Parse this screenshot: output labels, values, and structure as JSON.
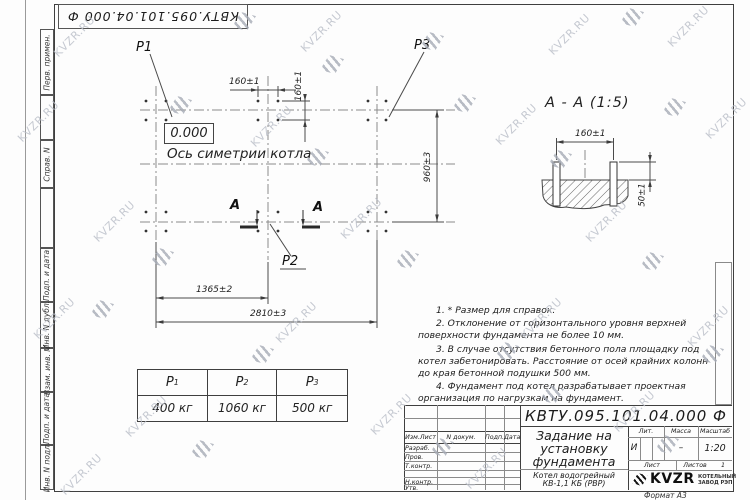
{
  "watermark": {
    "text": "KVZR.RU"
  },
  "frame": {
    "corner_doc_number": "КВТУ.095.101.04.000  Ф",
    "side_labels": [
      "Перв. примен.",
      "Справ. N",
      "Подп. и дата",
      "Инв. N дубл.",
      "Взам. инв. N",
      "Подп. и дата",
      "Инв. N подл."
    ],
    "format_label": "Формат А3"
  },
  "plan": {
    "p1_label": "Р1",
    "p2_label": "Р2",
    "p3_label": "Р3",
    "zero_level": "0.000",
    "axis_label": "Ось симетрии котла",
    "section_letter_left": "А",
    "section_letter_right": "А",
    "dims": {
      "bolt_pitch_h": "160±1",
      "bolt_pitch_v": "160±1",
      "width": "960±3",
      "half_length": "1365±2",
      "length": "2810±3"
    }
  },
  "section_view": {
    "title": "А - А (1:5)",
    "dims": {
      "bolt_pitch": "160±1",
      "bolt_height": "50±1"
    }
  },
  "loads_table": {
    "headers": [
      {
        "base": "Р",
        "sub": "1"
      },
      {
        "base": "Р",
        "sub": "2"
      },
      {
        "base": "Р",
        "sub": "3"
      }
    ],
    "values": [
      "400 кг",
      "1060 кг",
      "500 кг"
    ]
  },
  "notes": {
    "items": [
      "1. * Размер для справок.",
      "2. Отклонение от горизонтального уровня верхней поверхности фундамента не более 10 мм.",
      "3. В случае отсутствия бетонного пола площадку под котел забетонировать. Расстояние от осей крайних колонн до края бетонной подушки 500 мм.",
      "4. Фундамент под котел разрабатывает проектная организация по нагрузкам на фундамент."
    ]
  },
  "title_block": {
    "doc_number": "КВТУ.095.101.04.000  Ф",
    "title_lines": [
      "Задание на",
      "установку",
      "фундамента"
    ],
    "product_lines": [
      "Котел водогрейный",
      "КВ-1,1 КБ (РВР)"
    ],
    "header_cols": [
      "Изм.Лист",
      "N докум.",
      "Подп.",
      "Дата"
    ],
    "row_labels": [
      "Разраб.",
      "Пров.",
      "Т.контр.",
      "",
      "Н.контр.",
      "Утв."
    ],
    "lit_label": "Лит.",
    "lit_value": "И",
    "mass_label": "Масса",
    "mass_value": "–",
    "scale_label": "Масштаб",
    "scale_value": "1:20",
    "sheet_label": "Лист",
    "sheets_label": "Листов",
    "sheets_value": "1",
    "logo_text": "KVZR",
    "logo_caption_lines": [
      "КОТЕЛЬНЫЙ",
      "ЗАВОД РЭП"
    ]
  }
}
